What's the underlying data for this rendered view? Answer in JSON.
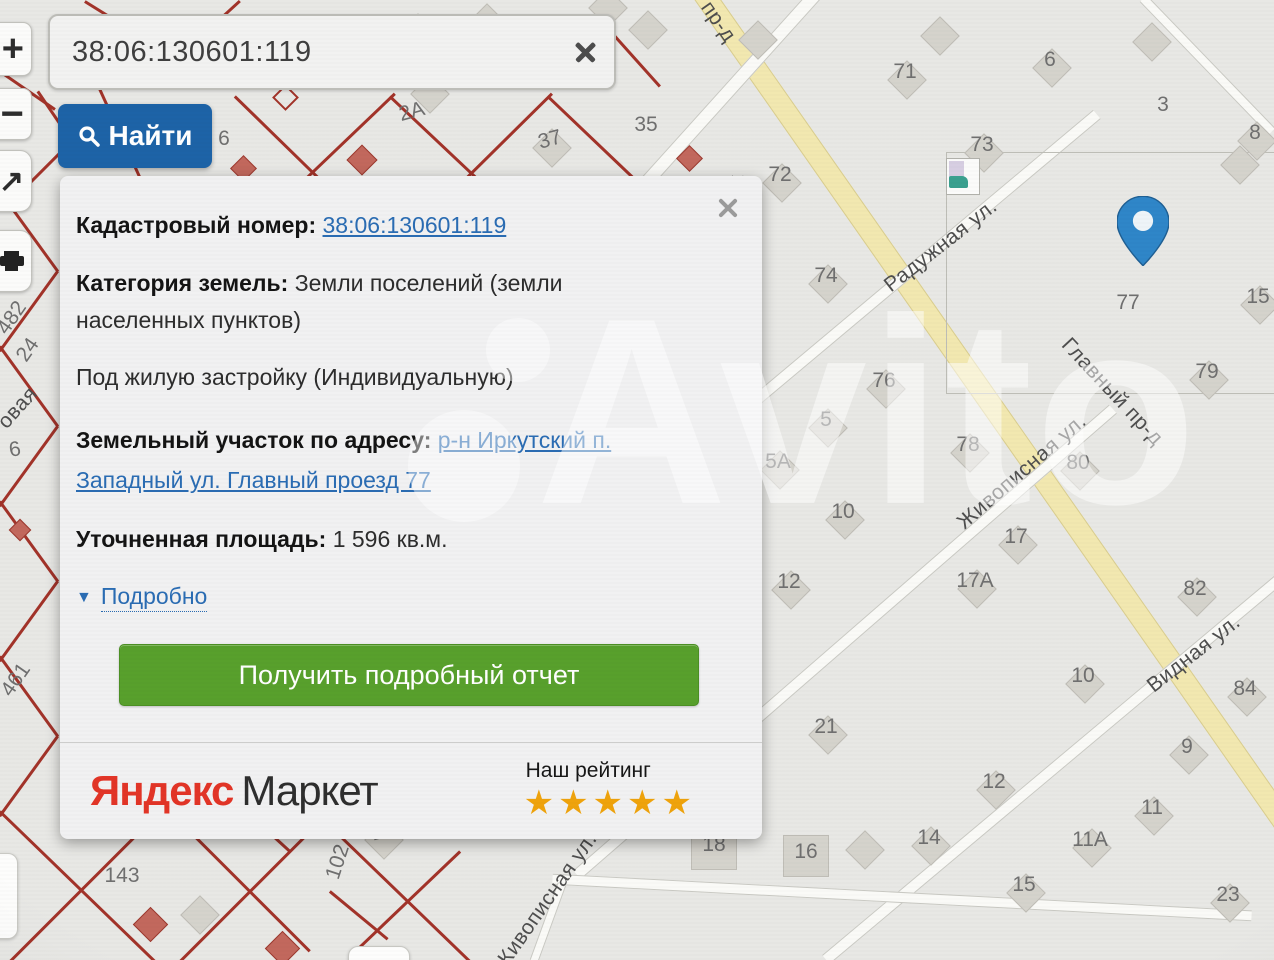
{
  "search_bar": {
    "value": "38:06:130601:119",
    "button_label": "Найти"
  },
  "toolbar": {
    "zoom_in": "+",
    "zoom_out": "−",
    "pan_arrow": "↗"
  },
  "info_panel": {
    "cadastral_label": "Кадастровый номер:",
    "cadastral_value": "38:06:130601:119",
    "category_label": "Категория земель:",
    "category_value": "Земли поселений (земли населенных пунктов)",
    "category_value2": "Под жилую застройку (Индивидуальную)",
    "address_label": "Земельный участок по адресу:",
    "address_value": "р-н Иркутский п. Западный ул. Главный проезд 77",
    "area_label": "Уточненная площадь:",
    "area_value": "1 596 кв.м.",
    "details_label": "Подробно",
    "report_button_label": "Получить подробный отчет",
    "footer": {
      "brand_red": "Яндекс",
      "brand_black": "Маркет",
      "rating_label": "Наш рейтинг",
      "stars_count": 5
    }
  },
  "map": {
    "watermark": "Avito",
    "colors": {
      "find_button_blue": "#1d63a7",
      "report_button_green": "#58a02c",
      "link_blue": "#2a6cb3",
      "cadastral_red": "#a23329",
      "road_yellow": "#f2e8b0",
      "marker_blue": "#2f86c8",
      "star_gold": "#efa30c",
      "yandex_red": "#e23527"
    },
    "streets": [
      {
        "label": "пр-д",
        "x": 718,
        "y": 22,
        "angle": 55
      },
      {
        "label": "Наличная ул.",
        "x": 703,
        "y": 228,
        "angle": -56
      },
      {
        "label": "Радужная ул.",
        "x": 941,
        "y": 246,
        "angle": -38
      },
      {
        "label": "Главный пр-д",
        "x": 1112,
        "y": 392,
        "angle": 47
      },
      {
        "label": "Живописная ул.",
        "x": 1022,
        "y": 472,
        "angle": -41
      },
      {
        "label": "Видная ул.",
        "x": 1194,
        "y": 654,
        "angle": -38
      },
      {
        "label": "Живописная ул.",
        "x": 546,
        "y": 902,
        "angle": -55
      },
      {
        "label": "овая",
        "x": 18,
        "y": 408,
        "angle": -48
      }
    ],
    "plot_numbers": [
      {
        "t": "71",
        "x": 905,
        "y": 72,
        "b": 1
      },
      {
        "t": "6",
        "x": 1050,
        "y": 60,
        "b": 1
      },
      {
        "t": "3",
        "x": 1163,
        "y": 105
      },
      {
        "t": "8",
        "x": 1255,
        "y": 133,
        "b": 1
      },
      {
        "t": "73",
        "x": 982,
        "y": 145,
        "b": 1
      },
      {
        "t": "35",
        "x": 646,
        "y": 125
      },
      {
        "t": "37",
        "x": 550,
        "y": 140,
        "a": -15,
        "b": 1
      },
      {
        "t": "2А",
        "x": 412,
        "y": 112,
        "a": -15
      },
      {
        "t": "72",
        "x": 780,
        "y": 175,
        "b": 1
      },
      {
        "t": "74",
        "x": 826,
        "y": 276,
        "b": 1
      },
      {
        "t": "77",
        "x": 1128,
        "y": 303
      },
      {
        "t": "15",
        "x": 1258,
        "y": 297,
        "b": 1
      },
      {
        "t": "79",
        "x": 1207,
        "y": 372,
        "b": 1
      },
      {
        "t": "76",
        "x": 884,
        "y": 381,
        "b": 1
      },
      {
        "t": "5",
        "x": 826,
        "y": 420,
        "b": 1
      },
      {
        "t": "5А",
        "x": 778,
        "y": 462,
        "b": 1
      },
      {
        "t": "78",
        "x": 968,
        "y": 445,
        "b": 1
      },
      {
        "t": "80",
        "x": 1078,
        "y": 463,
        "b": 1
      },
      {
        "t": "10",
        "x": 843,
        "y": 512,
        "b": 1
      },
      {
        "t": "17",
        "x": 1016,
        "y": 537,
        "b": 1
      },
      {
        "t": "12",
        "x": 789,
        "y": 582,
        "b": 1
      },
      {
        "t": "17А",
        "x": 975,
        "y": 581,
        "b": 1
      },
      {
        "t": "82",
        "x": 1195,
        "y": 589,
        "b": 1
      },
      {
        "t": "10",
        "x": 1083,
        "y": 676,
        "b": 1
      },
      {
        "t": "84",
        "x": 1245,
        "y": 689,
        "b": 1
      },
      {
        "t": "21",
        "x": 826,
        "y": 727,
        "b": 1
      },
      {
        "t": "9",
        "x": 1187,
        "y": 747,
        "b": 1
      },
      {
        "t": "12",
        "x": 994,
        "y": 782,
        "b": 1
      },
      {
        "t": "11",
        "x": 1152,
        "y": 808,
        "b": 1
      },
      {
        "t": "11А",
        "x": 1090,
        "y": 840,
        "b": 1
      },
      {
        "t": "14",
        "x": 929,
        "y": 838,
        "b": 1
      },
      {
        "t": "18",
        "x": 714,
        "y": 845,
        "sq": 1
      },
      {
        "t": "16",
        "x": 806,
        "y": 852,
        "sq": 1
      },
      {
        "t": "15",
        "x": 1024,
        "y": 885,
        "b": 1
      },
      {
        "t": "23",
        "x": 1228,
        "y": 895,
        "b": 1
      },
      {
        "t": "143",
        "x": 122,
        "y": 876
      },
      {
        "t": "102",
        "x": 338,
        "y": 862,
        "a": -72
      },
      {
        "t": "11",
        "x": 382,
        "y": 832,
        "a": -15,
        "b": 1
      },
      {
        "t": "482",
        "x": 12,
        "y": 318,
        "a": -55
      },
      {
        "t": "24",
        "x": 28,
        "y": 350,
        "a": -55
      },
      {
        "t": "6",
        "x": 15,
        "y": 450,
        "a": -10
      },
      {
        "t": "461",
        "x": 16,
        "y": 680,
        "a": -55
      },
      {
        "t": "6",
        "x": 224,
        "y": 139
      }
    ]
  }
}
